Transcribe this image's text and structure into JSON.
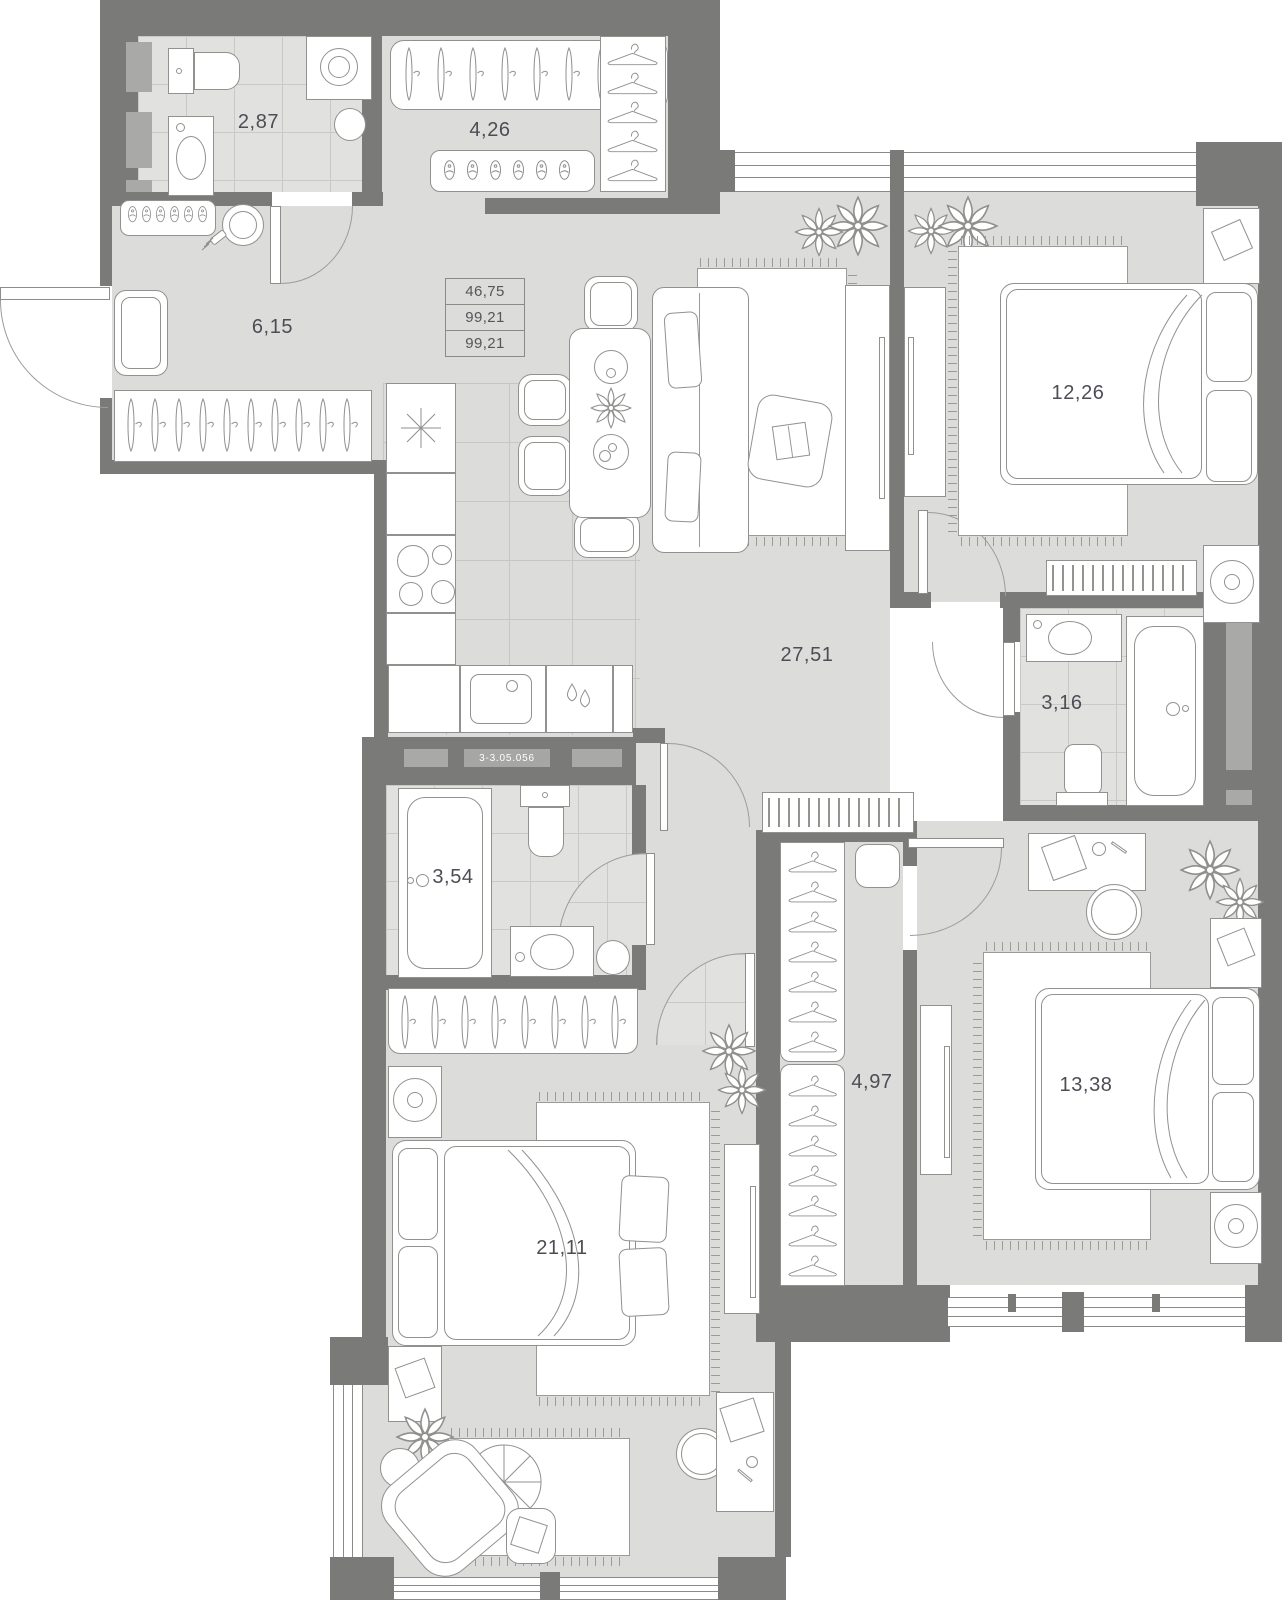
{
  "plan": {
    "badge": "3-3.05.056",
    "info_box": {
      "rows": [
        "46,75",
        "99,21",
        "99,21"
      ]
    },
    "rooms": [
      {
        "name": "bathroom-small",
        "area": "2,87"
      },
      {
        "name": "wardrobe",
        "area": "4,26"
      },
      {
        "name": "hallway",
        "area": "6,15"
      },
      {
        "name": "living-kitchen",
        "area": "27,51"
      },
      {
        "name": "bedroom-top-right",
        "area": "12,26"
      },
      {
        "name": "bathroom-right",
        "area": "3,16"
      },
      {
        "name": "bathroom-middle",
        "area": "3,54"
      },
      {
        "name": "walk-in-closet",
        "area": "4,97"
      },
      {
        "name": "bedroom-bottom-left",
        "area": "21,11"
      },
      {
        "name": "bedroom-bottom-right",
        "area": "13,38"
      }
    ]
  }
}
